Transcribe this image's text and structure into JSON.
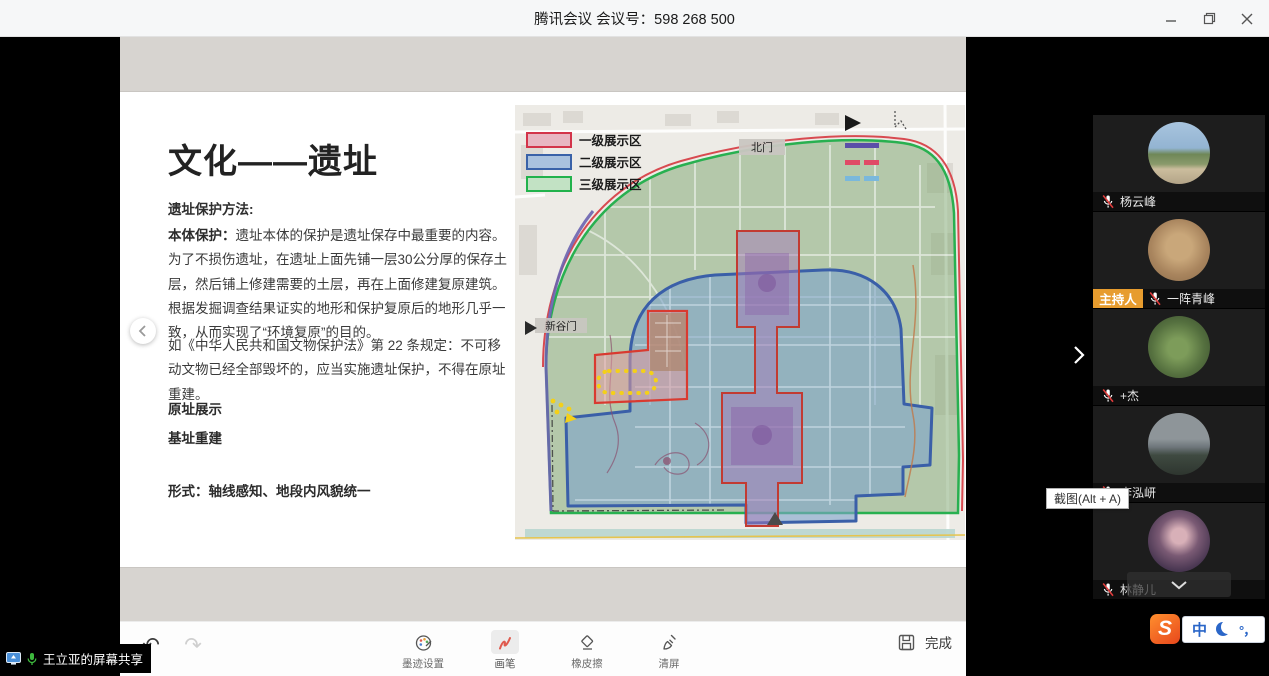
{
  "titlebar": {
    "title": "腾讯会议 会议号：598 268 500"
  },
  "slide": {
    "title": "文化——遗址",
    "subtitle": "遗址保护方法:",
    "para1_lead": "本体保护：",
    "para1": "遗址本体的保护是遗址保存中最重要的内容。为了不损伤遗址，在遗址上面先铺一层30公分厚的保存土层，然后铺上修建需要的土层，再在上面修建复原建筑。根据发掘调查结果证实的地形和保护复原后的地形几乎一致，从而实现了“环境复原”的目的。",
    "para2": "如《中华人民共和国文物保护法》第 22 条规定：不可移动文物已经全部毁坏的，应当实施遗址保护，不得在原址重建。",
    "item1": "原址展示",
    "item2": "基址重建",
    "form_line": "形式：轴线感知、地段内风貌统一"
  },
  "map": {
    "legend": [
      {
        "label": "一级展示区",
        "color": "#d3344a"
      },
      {
        "label": "二级展示区",
        "color": "#3a62a8"
      },
      {
        "label": "三级展示区",
        "color": "#22b24c"
      }
    ],
    "north_gate": "北门",
    "west_gate": "新谷门"
  },
  "sidebar": {
    "host_badge": "主持人",
    "participants": [
      {
        "name": "杨云峰"
      },
      {
        "name": "一阵青峰"
      },
      {
        "name": "+杰"
      },
      {
        "name": "李泓岍"
      },
      {
        "name": "林静儿"
      }
    ]
  },
  "tooltip": {
    "text": "截图(Alt + A)"
  },
  "toolbar": {
    "ink_settings": "墨迹设置",
    "pen": "画笔",
    "eraser": "橡皮擦",
    "clear": "清屏",
    "done": "完成"
  },
  "overlay": {
    "presenter": "王立亚的屏幕共享"
  },
  "ime": {
    "logo": "S",
    "lang": "中",
    "punct": "°，"
  }
}
